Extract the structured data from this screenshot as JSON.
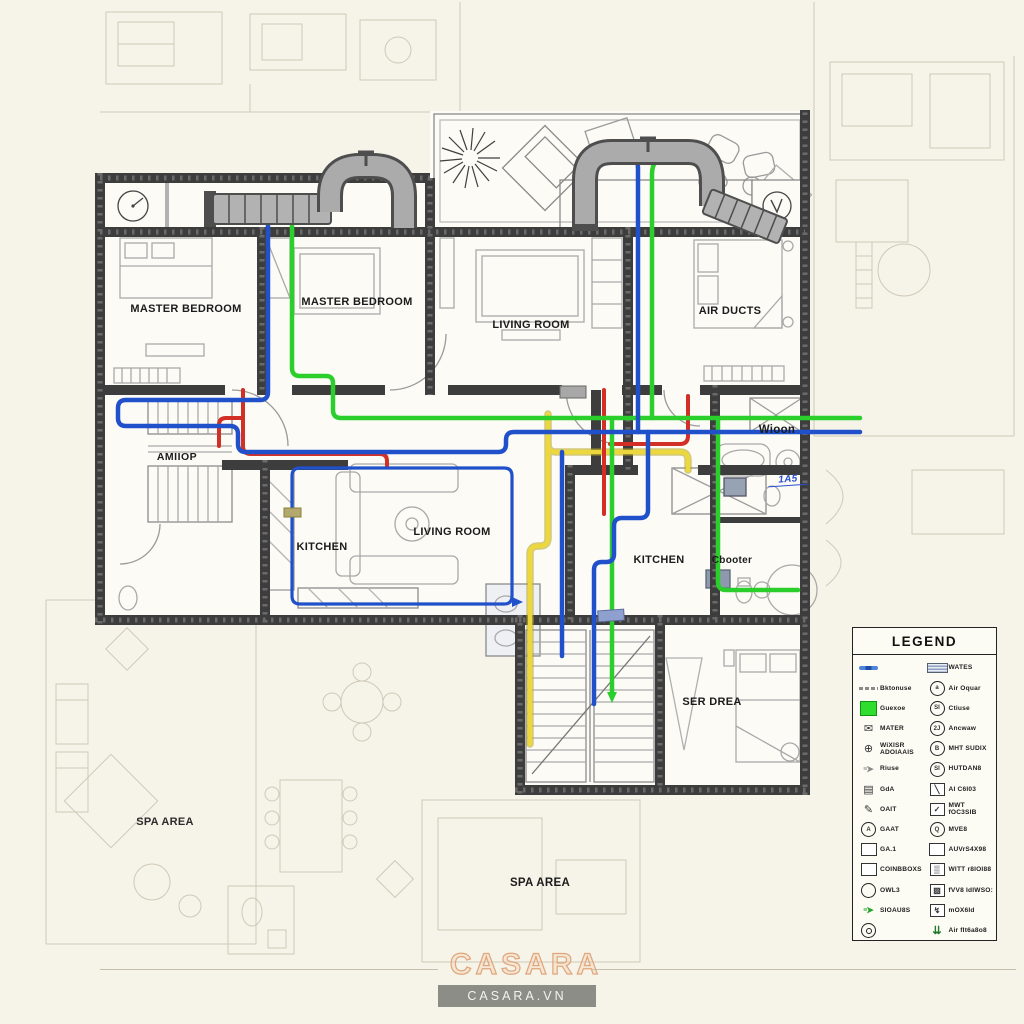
{
  "watermark": {
    "brand": "CASARA",
    "site": "CASARA.VN"
  },
  "rooms": {
    "master_bedroom_left": "MASTER BEDROOM",
    "master_bedroom_mid": "MASTER BEDROOM",
    "living_room_top": "LIVING ROOM",
    "air_ducts": "AIR DUCTS",
    "hall_stairs": "AMIIOP",
    "kitchen_left": "KITCHEN",
    "living_room_center": "LIVING ROOM",
    "bathroom_right": "Wioon",
    "bath_tag": "1A5",
    "kitchen_right": "KITCHEN",
    "closet_right": "Cbooter",
    "bedroom_right": "SER DREA",
    "spa_left": "SPA AREA",
    "spa_center": "SPA AREA"
  },
  "legend": {
    "title": "LEGEND",
    "left": [
      {
        "icon": "water-pipe-icon",
        "type": "pipe-blue",
        "label": ""
      },
      {
        "icon": "duct-line-icon",
        "type": "dash-gray",
        "label": "Bktonuse"
      },
      {
        "icon": "supply-square-icon",
        "type": "square-green",
        "label": "Guexoe"
      },
      {
        "icon": "vent-envelope-icon",
        "type": "char",
        "char": "✉",
        "label": "MATER"
      },
      {
        "icon": "globe-valve-icon",
        "type": "char",
        "char": "⊕",
        "label": "WiXISR ADOIAAIS"
      },
      {
        "icon": "flow-arrow-icon",
        "type": "arrow-gray",
        "char": "➤",
        "label": "Riuse"
      },
      {
        "icon": "clamp-icon",
        "type": "char",
        "char": "▤",
        "label": "GdA"
      },
      {
        "icon": "pen-icon",
        "type": "char",
        "char": "✎",
        "label": "OAIT"
      },
      {
        "icon": "circle-a-icon",
        "type": "circle",
        "badge": "A",
        "label": "GAAT"
      },
      {
        "icon": "gas-box-icon",
        "type": "box",
        "label": "GA.1"
      },
      {
        "icon": "control-box-icon",
        "type": "box",
        "label": "COINBBOXS"
      },
      {
        "icon": "outlet-circle-icon",
        "type": "circle",
        "label": "OWL3"
      },
      {
        "icon": "supply-arrow-icon",
        "type": "arrow-green",
        "char": "➤",
        "label": "SIOAU8S"
      },
      {
        "icon": "camera-circle-icon",
        "type": "circle-dot",
        "label": ""
      }
    ],
    "right": [
      {
        "icon": "water-meter-icon",
        "type": "striped",
        "label": "WATES"
      },
      {
        "icon": "air-outlet-icon",
        "type": "circle",
        "badge": "a",
        "label": "Air Oquar"
      },
      {
        "icon": "closet-icon",
        "type": "circle",
        "badge": "SI",
        "label": "Ctiuse"
      },
      {
        "icon": "ancillary-icon",
        "type": "circle",
        "badge": "2J",
        "label": "Ancwaw"
      },
      {
        "icon": "air-supply-icon",
        "type": "circle",
        "badge": "B",
        "label": "MHT SUDIX"
      },
      {
        "icon": "heating-icon",
        "type": "circle",
        "badge": "SI",
        "label": "HUTDAN8"
      },
      {
        "icon": "aircon-box-icon",
        "type": "box-char",
        "char": "╲",
        "label": "AI C6I03"
      },
      {
        "icon": "checked-box-icon",
        "type": "box-char",
        "char": "✓",
        "label": "MWT fOC3SIB"
      },
      {
        "icon": "meter-circle-icon",
        "type": "circle",
        "badge": "Q",
        "label": "MVE8"
      },
      {
        "icon": "access-box-icon",
        "type": "box",
        "label": "AUVrS4X98"
      },
      {
        "icon": "wire-panel-icon",
        "type": "box-char",
        "char": "▒",
        "label": "WITT r8IOI88"
      },
      {
        "icon": "wave-box-icon",
        "type": "box-char",
        "char": "▨",
        "label": "fVV8 IdIWSO:"
      },
      {
        "icon": "mixer-box-icon",
        "type": "box-char",
        "char": "↯",
        "label": "mOX6Id"
      },
      {
        "icon": "air-release-icon",
        "type": "char-green",
        "char": "⇊",
        "label": "Air fIt6a8o8"
      }
    ]
  },
  "colors": {
    "pipe_blue": "#2150cb",
    "pipe_green": "#2bcf2b",
    "pipe_red": "#d23026",
    "pipe_yellow": "#ecd83e",
    "wall": "#3d3d3d",
    "duct": "#ababab",
    "accent_peach": "#e0a57a"
  }
}
